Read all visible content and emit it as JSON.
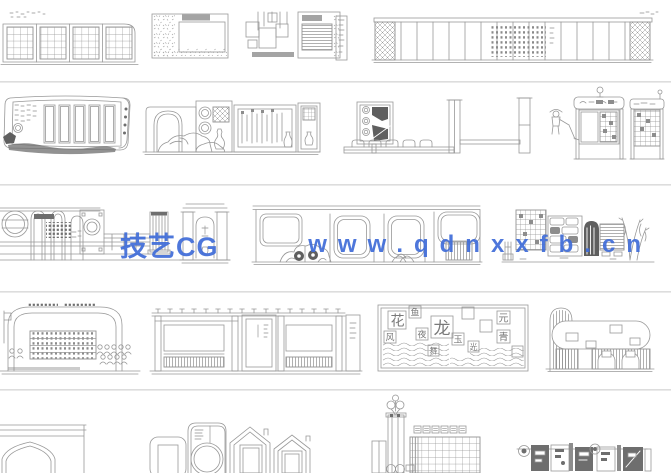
{
  "watermark": {
    "brand": "技艺CG",
    "url": "www.qdnxxfb.cn",
    "color": "#3F6CD8"
  },
  "calligraphy_wall": {
    "characters": [
      "花",
      "鱼",
      "龙",
      "夜",
      "风",
      "玉",
      "元",
      "青",
      "光",
      "舞"
    ]
  }
}
